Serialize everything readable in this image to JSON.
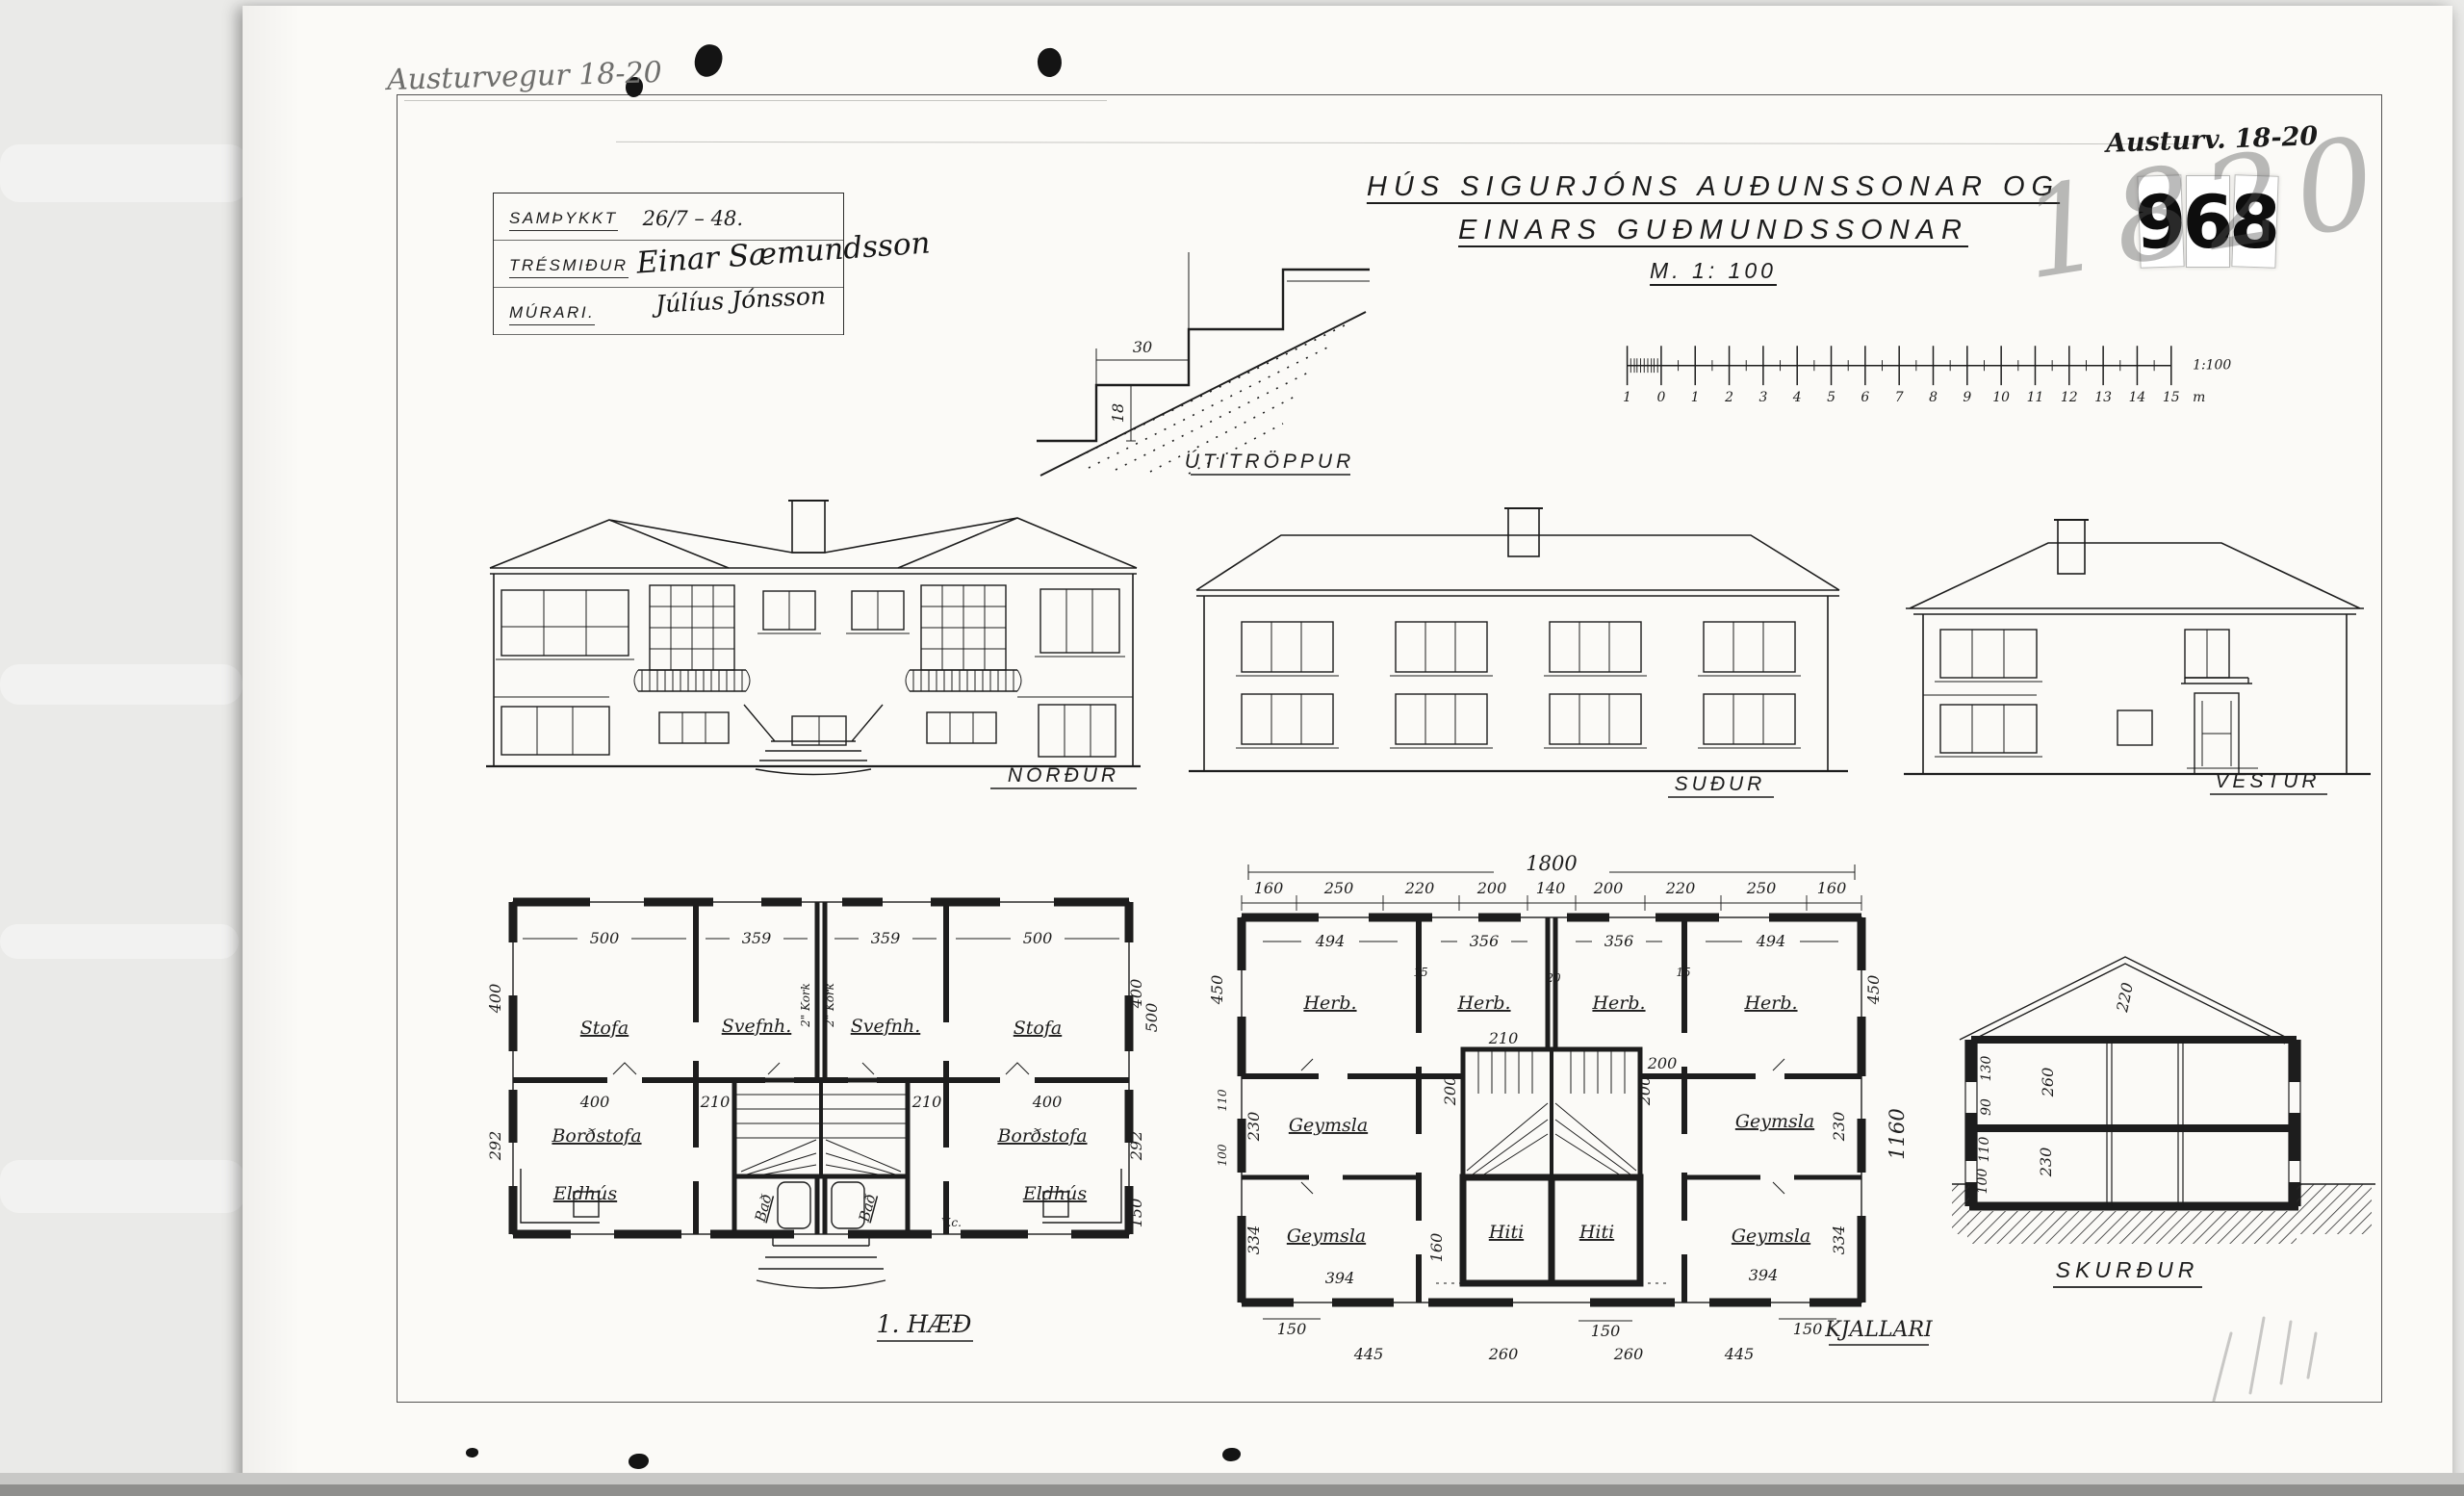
{
  "meta": {
    "address_pencil": "Austurvegur 18-20",
    "address_marker": "Austurv. 18-20",
    "stamp_digits": [
      "9",
      "6",
      "8"
    ],
    "scribble": "1820"
  },
  "approval": {
    "rows": [
      {
        "label": "SAMÞYKKT",
        "value": "26/7 – 48."
      },
      {
        "label": "TRÉSMIÐUR",
        "value": ""
      },
      {
        "label": "MÚRARI.",
        "value": ""
      }
    ],
    "signature_carpenter": "Einar Sæmundsson",
    "signature_mason": "Júlíus Jónsson"
  },
  "title": {
    "line1": "HÚS SIGURJÓNS AUÐUNSSONAR OG",
    "line2": "EINARS GUÐMUNDSSONAR",
    "scale": "M. 1: 100"
  },
  "stair_detail": {
    "label": "ÚTITRÖPPUR",
    "tread": "30",
    "riser": "18"
  },
  "scale_bar": {
    "ticks": [
      "1",
      "0",
      "1",
      "2",
      "3",
      "4",
      "5",
      "6",
      "7",
      "8",
      "9",
      "10",
      "11",
      "12",
      "13",
      "14",
      "15"
    ],
    "unit": "m",
    "ratio": "1:100"
  },
  "elevations": {
    "north": "NORÐUR",
    "south": "SUÐUR",
    "west": "VESTUR"
  },
  "ff": {
    "label": "1. HÆÐ",
    "room_stofa": "Stofa",
    "room_svefnh": "Svefnh.",
    "room_bordstofa": "Borðstofa",
    "room_eldhus": "Eldhús",
    "room_bad": "Bað",
    "room_vc": "V.c.",
    "kork": "2\" Kork",
    "d500": "500",
    "d359": "359",
    "d400": "400",
    "d210": "210",
    "d292": "292",
    "d150": "150"
  },
  "kj": {
    "label": "KJALLARI",
    "overall": "1800",
    "seg": [
      "160",
      "250",
      "220",
      "200",
      "140",
      "200",
      "220",
      "250",
      "160"
    ],
    "dr": [
      "494",
      "356",
      "356",
      "494"
    ],
    "room_herb": "Herb.",
    "room_geymsla": "Geymsla",
    "room_hiti": "Hiti",
    "d450": "450",
    "d1160": "1160",
    "d230": "230",
    "d334": "334",
    "d394": "394",
    "d445": "445",
    "d260": "260",
    "d150": "150",
    "d210": "210",
    "d200": "200",
    "d160": "160",
    "d110": "110",
    "d100": "100",
    "d15": "15",
    "d20": "20"
  },
  "sec": {
    "label": "SKURÐUR",
    "d220": "220",
    "d260": "260",
    "d230": "230",
    "d130": "130",
    "d90": "90",
    "d110": "110",
    "d100": "100"
  }
}
